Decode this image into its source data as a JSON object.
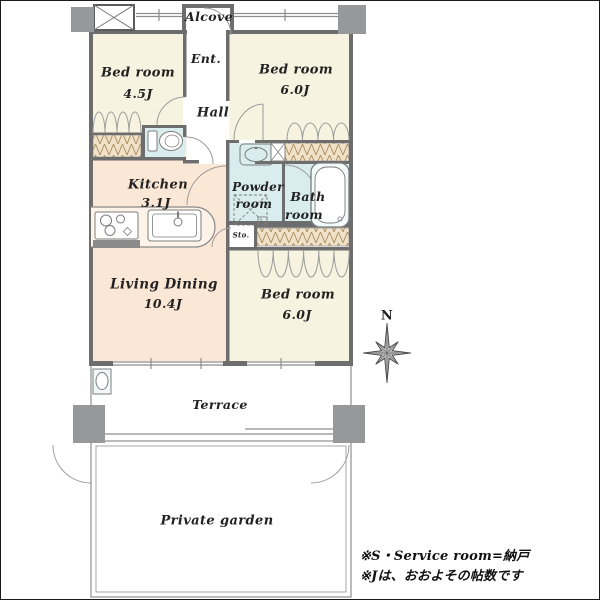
{
  "rooms": {
    "alcove": {
      "name": "Alcove"
    },
    "entrance": {
      "name": "Ent."
    },
    "hall": {
      "name": "Hall"
    },
    "bedroom_top_left": {
      "name": "Bed room",
      "size": "4.5J"
    },
    "bedroom_top_right": {
      "name": "Bed room",
      "size": "6.0J"
    },
    "bedroom_mid_right": {
      "name": "Bed room",
      "size": "6.0J"
    },
    "kitchen": {
      "name": "Kitchen",
      "size": "3.1J"
    },
    "living_dining": {
      "name": "Living Dining",
      "size": "10.4J"
    },
    "powder_room": {
      "name_line1": "Powder",
      "name_line2": "room"
    },
    "bath_room": {
      "name_line1": "Bath",
      "name_line2": "room"
    },
    "storage": {
      "name": "Sto."
    },
    "terrace": {
      "name": "Terrace"
    },
    "private_garden": {
      "name": "Private garden"
    }
  },
  "compass": {
    "north_label": "N"
  },
  "footnotes": {
    "line1": "※S・Service room=納戸",
    "line2": "※Jは、おおよその帖数です"
  },
  "colors": {
    "bedroom_floor": "#f6f3e1",
    "living_kitchen_floor": "#fbe7d6",
    "wet_area_floor": "#d9edee",
    "closet_fill": "#f0e2c8",
    "wall": "#6d6d6d",
    "pillar": "#97989a"
  }
}
